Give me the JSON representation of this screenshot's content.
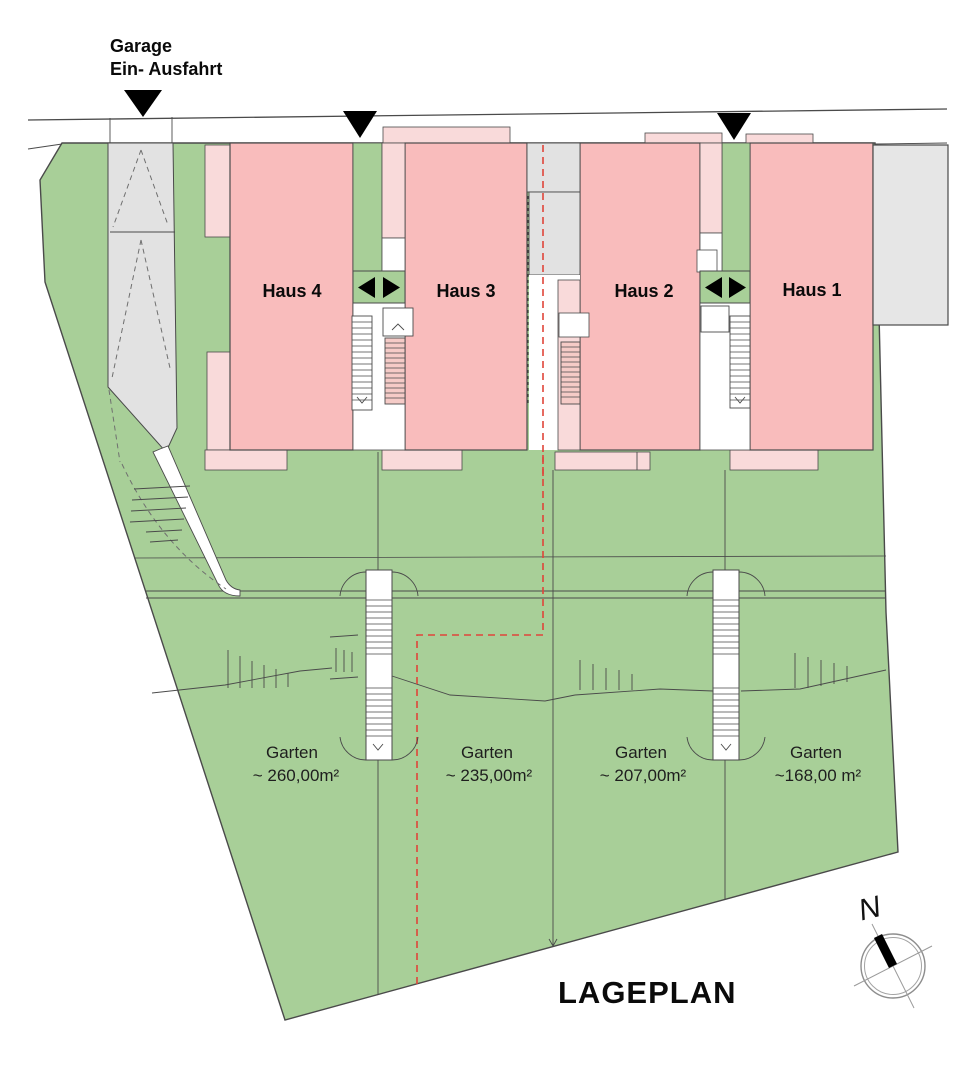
{
  "page": {
    "title": "LAGEPLAN"
  },
  "entrance": {
    "line1": "Garage",
    "line2": "Ein- Ausfahrt"
  },
  "houses": [
    {
      "label": "Haus 4"
    },
    {
      "label": "Haus 3"
    },
    {
      "label": "Haus 2"
    },
    {
      "label": "Haus 1"
    }
  ],
  "gardens": [
    {
      "label": "Garten",
      "area": "~ 260,00m²"
    },
    {
      "label": "Garten",
      "area": "~ 235,00m²"
    },
    {
      "label": "Garten",
      "area": "~ 207,00m²"
    },
    {
      "label": "Garten",
      "area": "~168,00 m²"
    }
  ],
  "compass": {
    "label": "N"
  },
  "colors": {
    "plot-green": "#a8cf98",
    "house-pink": "#f9bcbc",
    "porch-pink": "#f9dada",
    "ladder-pink": "#f5cbc7",
    "paving-gray": "#e2e2e2",
    "building-gray": "#e6e6e6",
    "line-dark": "#4a4a4a",
    "boundary-red": "#e0453a",
    "marker-black": "#000000"
  }
}
